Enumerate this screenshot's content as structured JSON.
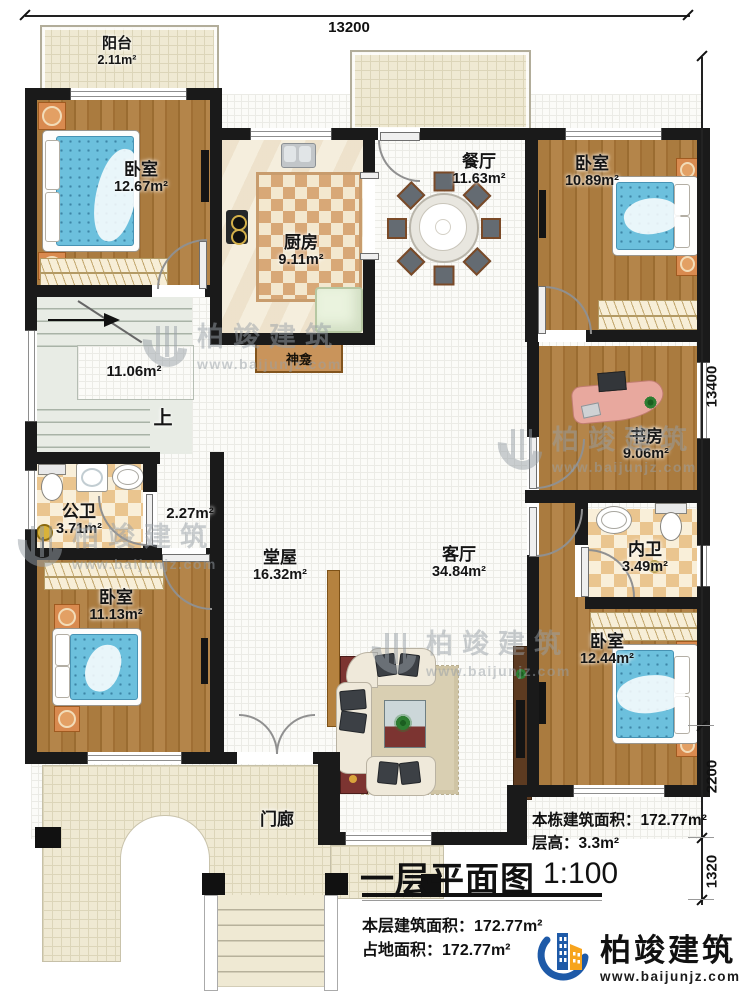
{
  "plan": {
    "dimensions": {
      "top_width": "13200",
      "right_height": "13400",
      "right_lower": "2200",
      "right_bottom": "1320"
    },
    "rooms": {
      "balcony": {
        "name": "阳台",
        "area": "2.11m²"
      },
      "bedroom_top_left": {
        "name": "卧室",
        "area": "12.67m²"
      },
      "kitchen": {
        "name": "厨房",
        "area": "9.11m²"
      },
      "dining": {
        "name": "餐厅",
        "area": "11.63m²"
      },
      "bedroom_top_right": {
        "name": "卧室",
        "area": "10.89m²"
      },
      "stair_hall": {
        "area": "11.06m²",
        "up_label": "上"
      },
      "shrine": {
        "name": "神龛"
      },
      "study": {
        "name": "书房",
        "area": "9.06m²"
      },
      "public_bath": {
        "name": "公卫",
        "area": "3.71m²"
      },
      "corridor": {
        "area": "2.27m²"
      },
      "hall": {
        "name": "堂屋",
        "area": "16.32m²"
      },
      "living": {
        "name": "客厅",
        "area": "34.84m²"
      },
      "inner_bath": {
        "name": "内卫",
        "area": "3.49m²"
      },
      "bedroom_bottom_left": {
        "name": "卧室",
        "area": "11.13m²"
      },
      "bedroom_bottom_right": {
        "name": "卧室",
        "area": "12.44m²"
      },
      "porch": {
        "name": "门廊"
      }
    }
  },
  "title_block": {
    "title": "一层平面图",
    "scale": "1:100",
    "building_area_label": "本栋建筑面积：",
    "building_area_value": "172.77m²",
    "storey_height_label": "层高：",
    "storey_height_value": "3.3m²",
    "floor_area_label": "本层建筑面积：",
    "floor_area_value": "172.77m²",
    "site_area_label": "占地面积：",
    "site_area_value": "172.77m²"
  },
  "branding": {
    "logo_text": "柏竣建筑",
    "logo_url": "www.baijunjz.com",
    "logo_blue": "#1e5aa8",
    "logo_orange": "#f7a41d"
  },
  "watermark": {
    "text": "柏竣建筑",
    "url": "www.baijunjz.com"
  }
}
